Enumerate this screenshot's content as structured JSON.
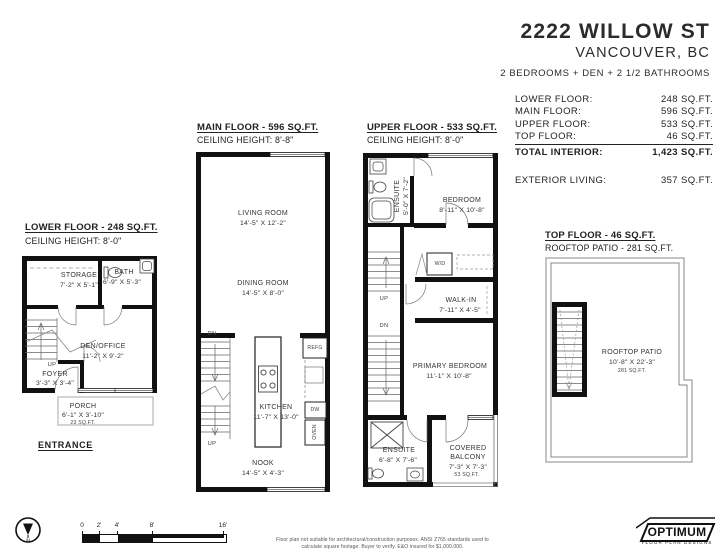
{
  "header": {
    "title": "2222 WILLOW ST",
    "city": "VANCOUVER, BC",
    "summary": "2 BEDROOMS + DEN + 2 1/2 BATHROOMS"
  },
  "area_table": {
    "rows": [
      {
        "label": "LOWER FLOOR:",
        "value": "248 SQ.FT."
      },
      {
        "label": "MAIN FLOOR:",
        "value": "596 SQ.FT."
      },
      {
        "label": "UPPER FLOOR:",
        "value": "533 SQ.FT."
      },
      {
        "label": "TOP FLOOR:",
        "value": "46 SQ.FT."
      }
    ],
    "total_label": "TOTAL INTERIOR:",
    "total_value": "1,423 SQ.FT.",
    "exterior_label": "EXTERIOR LIVING:",
    "exterior_value": "357 SQ.FT."
  },
  "lower": {
    "title": "LOWER FLOOR - 248 SQ.FT.",
    "ceiling": "CEILING HEIGHT: 8'-0\"",
    "storage_name": "STORAGE",
    "storage_dims": "7'-2\" X 5'-1\"",
    "bath_name": "BATH",
    "bath_dims": "6'-9\" X 5'-3\"",
    "den_name": "DEN/OFFICE",
    "den_dims": "11'-2\" X 9'-2\"",
    "foyer_name": "FOYER",
    "foyer_dims": "3'-3\" X 3'-4\"",
    "porch_name": "PORCH",
    "porch_dims": "6'-1\" X 3'-10\"",
    "porch_area": "23 SQ.FT.",
    "up": "UP",
    "entrance": "ENTRANCE"
  },
  "main": {
    "title": "MAIN FLOOR - 596 SQ.FT.",
    "ceiling": "CEILING HEIGHT: 8'-8\"",
    "living_name": "LIVING ROOM",
    "living_dims": "14'-5\" X 12'-2\"",
    "dining_name": "DINING ROOM",
    "dining_dims": "14'-5\" X 8'-0\"",
    "kitchen_name": "KITCHEN",
    "kitchen_dims": "11'-7\" X 13'-0\"",
    "nook_name": "NOOK",
    "nook_dims": "14'-5\" X 4'-3\"",
    "refg": "REFG",
    "dw": "DW",
    "oven": "OVEN",
    "dn": "DN",
    "up": "UP"
  },
  "upper": {
    "title": "UPPER FLOOR - 533 SQ.FT.",
    "ceiling": "CEILING HEIGHT: 8'-0\"",
    "ensuite_top_name": "ENSUITE",
    "ensuite_top_dims": "5'-0\" X 7'-2\"",
    "bedroom_name": "BEDROOM",
    "bedroom_dims": "8'-11\" X 10'-8\"",
    "walkin_name": "WALK-IN",
    "walkin_dims": "7'-11\" X 4'-5\"",
    "primary_name": "PRIMARY BEDROOM",
    "primary_dims": "11'-1\" X 10'-8\"",
    "ensuite_bottom_name": "ENSUITE",
    "ensuite_bottom_dims": "6'-8\" X 7'-6\"",
    "balcony_name_1": "COVERED",
    "balcony_name_2": "BALCONY",
    "balcony_dims": "7'-3\" X 7'-3\"",
    "balcony_area": "53 SQ.FT.",
    "wd": "W/D",
    "up": "UP",
    "dn": "DN"
  },
  "top": {
    "title": "TOP FLOOR - 46 SQ.FT.",
    "subtitle": "ROOFTOP PATIO - 281 SQ.FT.",
    "patio_name": "ROOFTOP PATIO",
    "patio_dims": "10'-8\" X 22'-3\"",
    "patio_area": "281 SQ.FT."
  },
  "footer": {
    "compass": "N",
    "scale_ticks": [
      "0",
      "2'",
      "4'",
      "8'",
      "16'"
    ],
    "disclaimer1": "Floor plan not suitable for architectural/construction purposes. ANSI Z765 standards used to",
    "disclaimer2": "calculate square footage. Buyer to verify.  E&O insured for $1,000,000.",
    "logo_name": "OPTIMUM",
    "logo_tagline": "FLOOR PLAN DESIGNS"
  }
}
